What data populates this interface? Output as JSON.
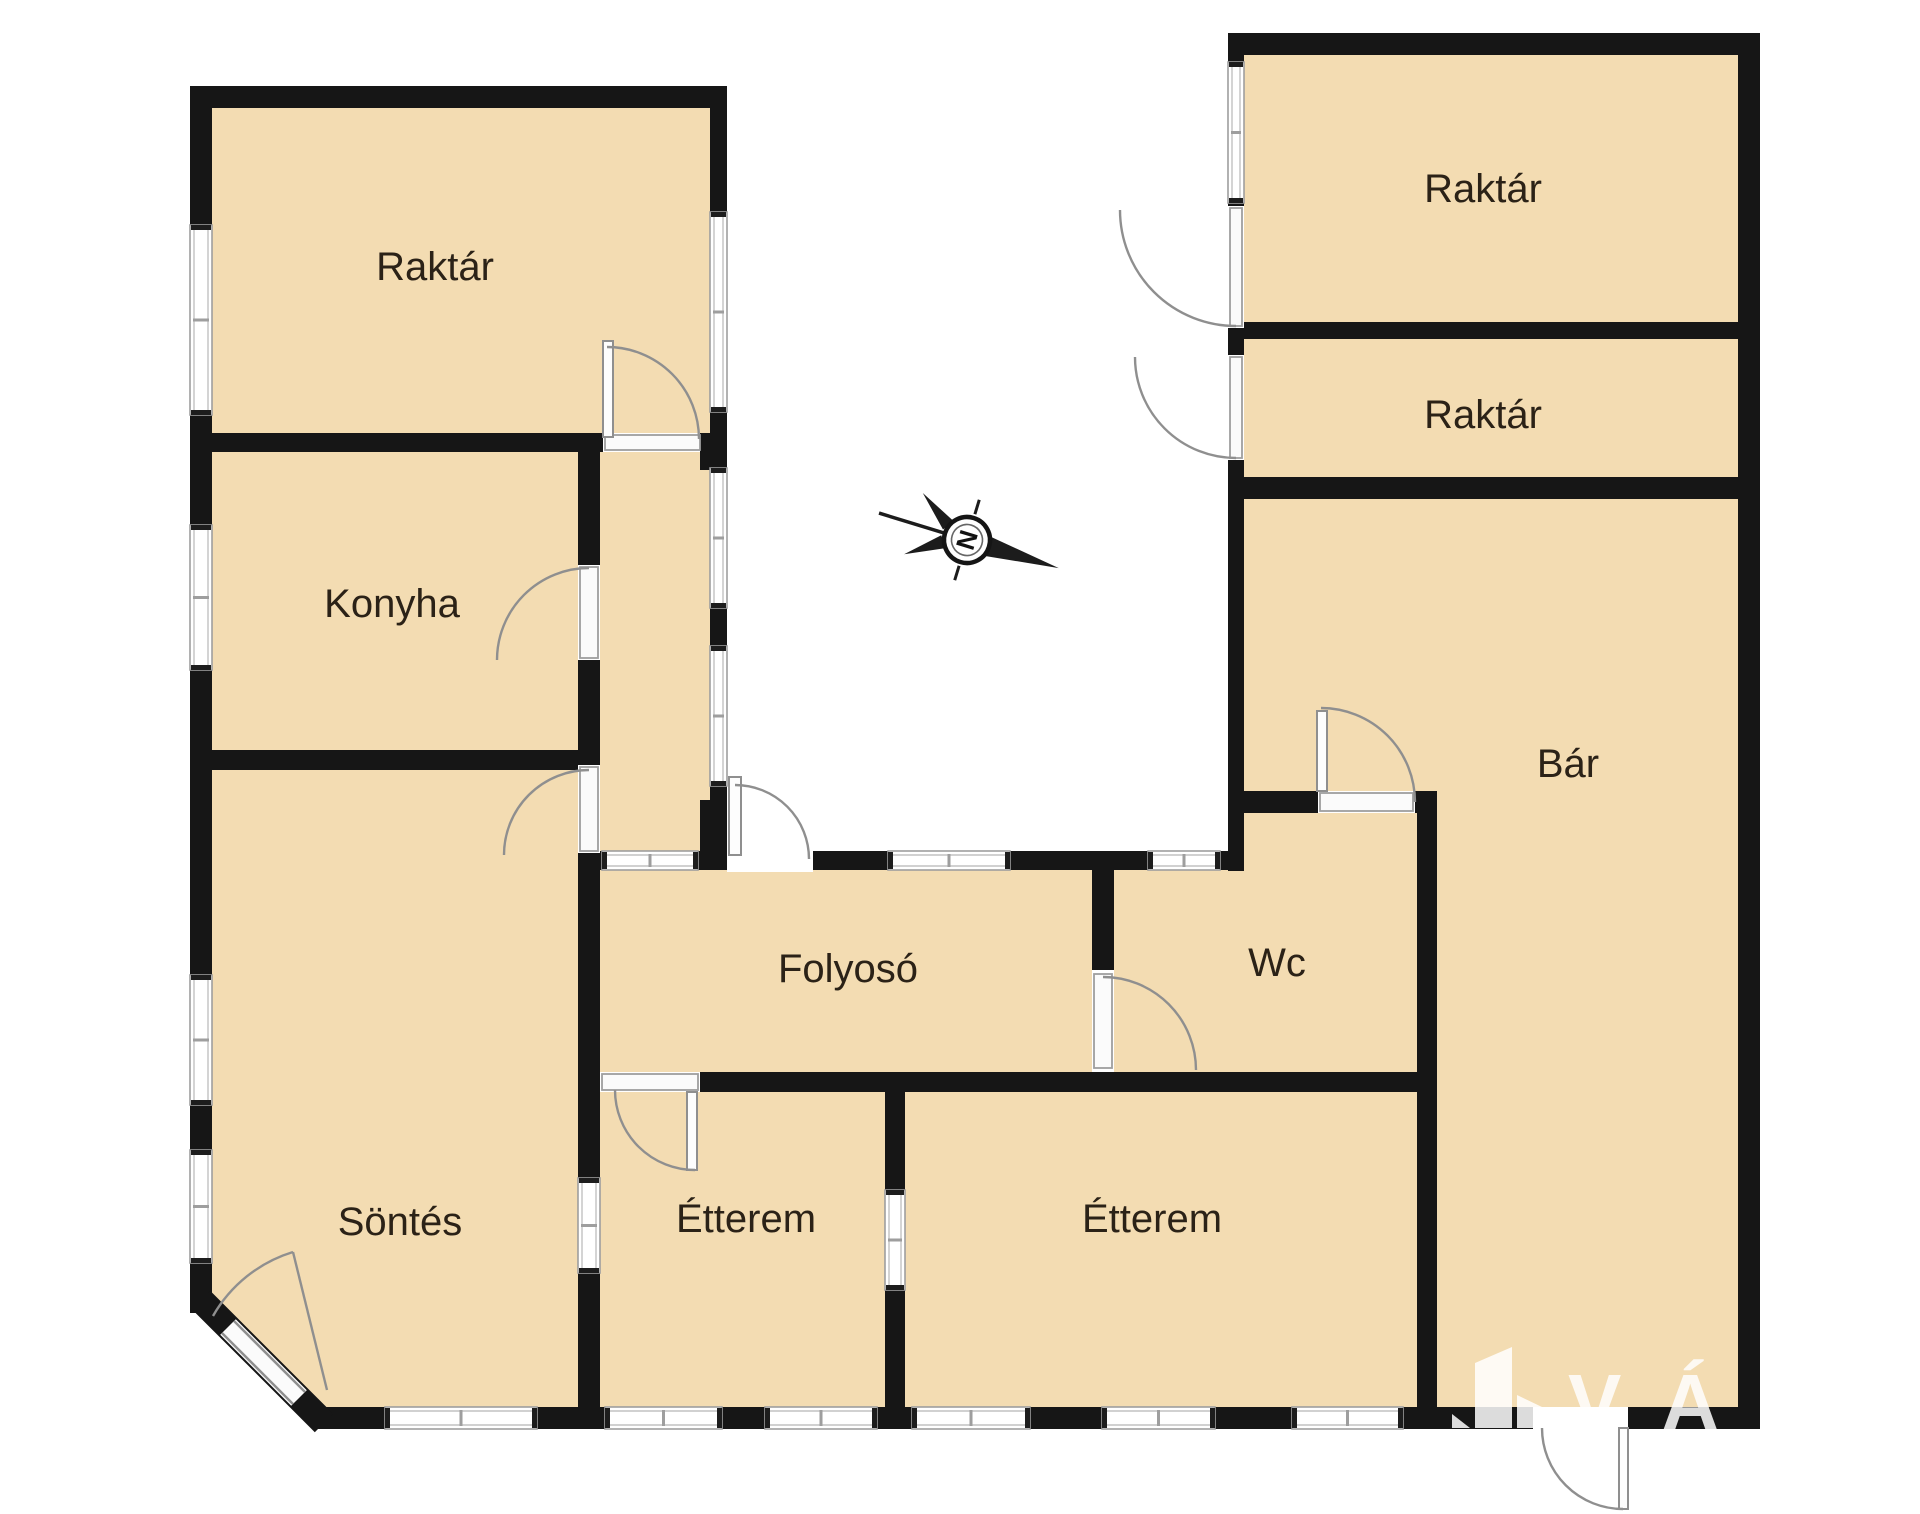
{
  "plan": {
    "title": "Alaprajz",
    "colors": {
      "background": "#ffffff",
      "room_fill": "#f3dcb2",
      "wall": "#161616",
      "label": "#2b2217",
      "door_arc": "#8f8f8f",
      "window_frame": "#9e9e9e",
      "watermark": "#ffffff"
    }
  },
  "rooms": [
    {
      "id": "raktar-top-left",
      "label": "Raktár",
      "x": 435,
      "y": 280
    },
    {
      "id": "konyha",
      "label": "Konyha",
      "x": 392,
      "y": 617
    },
    {
      "id": "sontes",
      "label": "Söntés",
      "x": 400,
      "y": 1235
    },
    {
      "id": "folyoso",
      "label": "Folyosó",
      "x": 848,
      "y": 982
    },
    {
      "id": "etterem-west",
      "label": "Étterem",
      "x": 746,
      "y": 1232
    },
    {
      "id": "etterem-east",
      "label": "Étterem",
      "x": 1152,
      "y": 1232
    },
    {
      "id": "wc",
      "label": "Wc",
      "x": 1277,
      "y": 976
    },
    {
      "id": "bar",
      "label": "Bár",
      "x": 1568,
      "y": 777
    },
    {
      "id": "raktar-right-upper",
      "label": "Raktár",
      "x": 1483,
      "y": 202
    },
    {
      "id": "raktar-right-lower",
      "label": "Raktár",
      "x": 1483,
      "y": 428
    }
  ],
  "compass": {
    "letter": "N",
    "cx": 967,
    "cy": 540,
    "rotation": 17
  },
  "watermark": {
    "text": "VÁRO",
    "icon": "building-logo-icon"
  }
}
